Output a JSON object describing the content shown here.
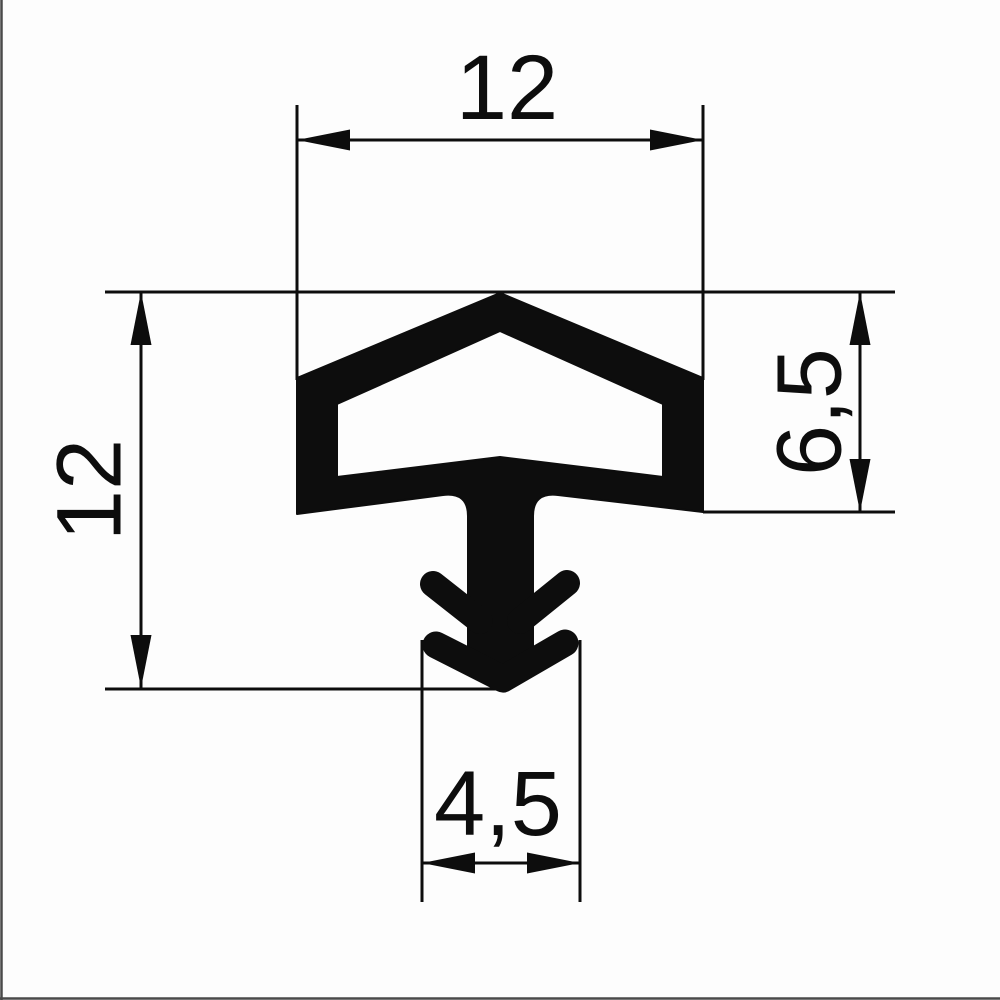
{
  "drawing": {
    "kind": "technical-dimension-drawing",
    "subject": "seal-profile-cross-section",
    "background_color": "#fdfdfd",
    "ink_color": "#0d0d0d",
    "photo_edge_color": "#4a4a4a",
    "dimensions": {
      "top_width": "12",
      "left_height": "12",
      "right_height": "6,5",
      "bottom_width": "4,5"
    }
  }
}
